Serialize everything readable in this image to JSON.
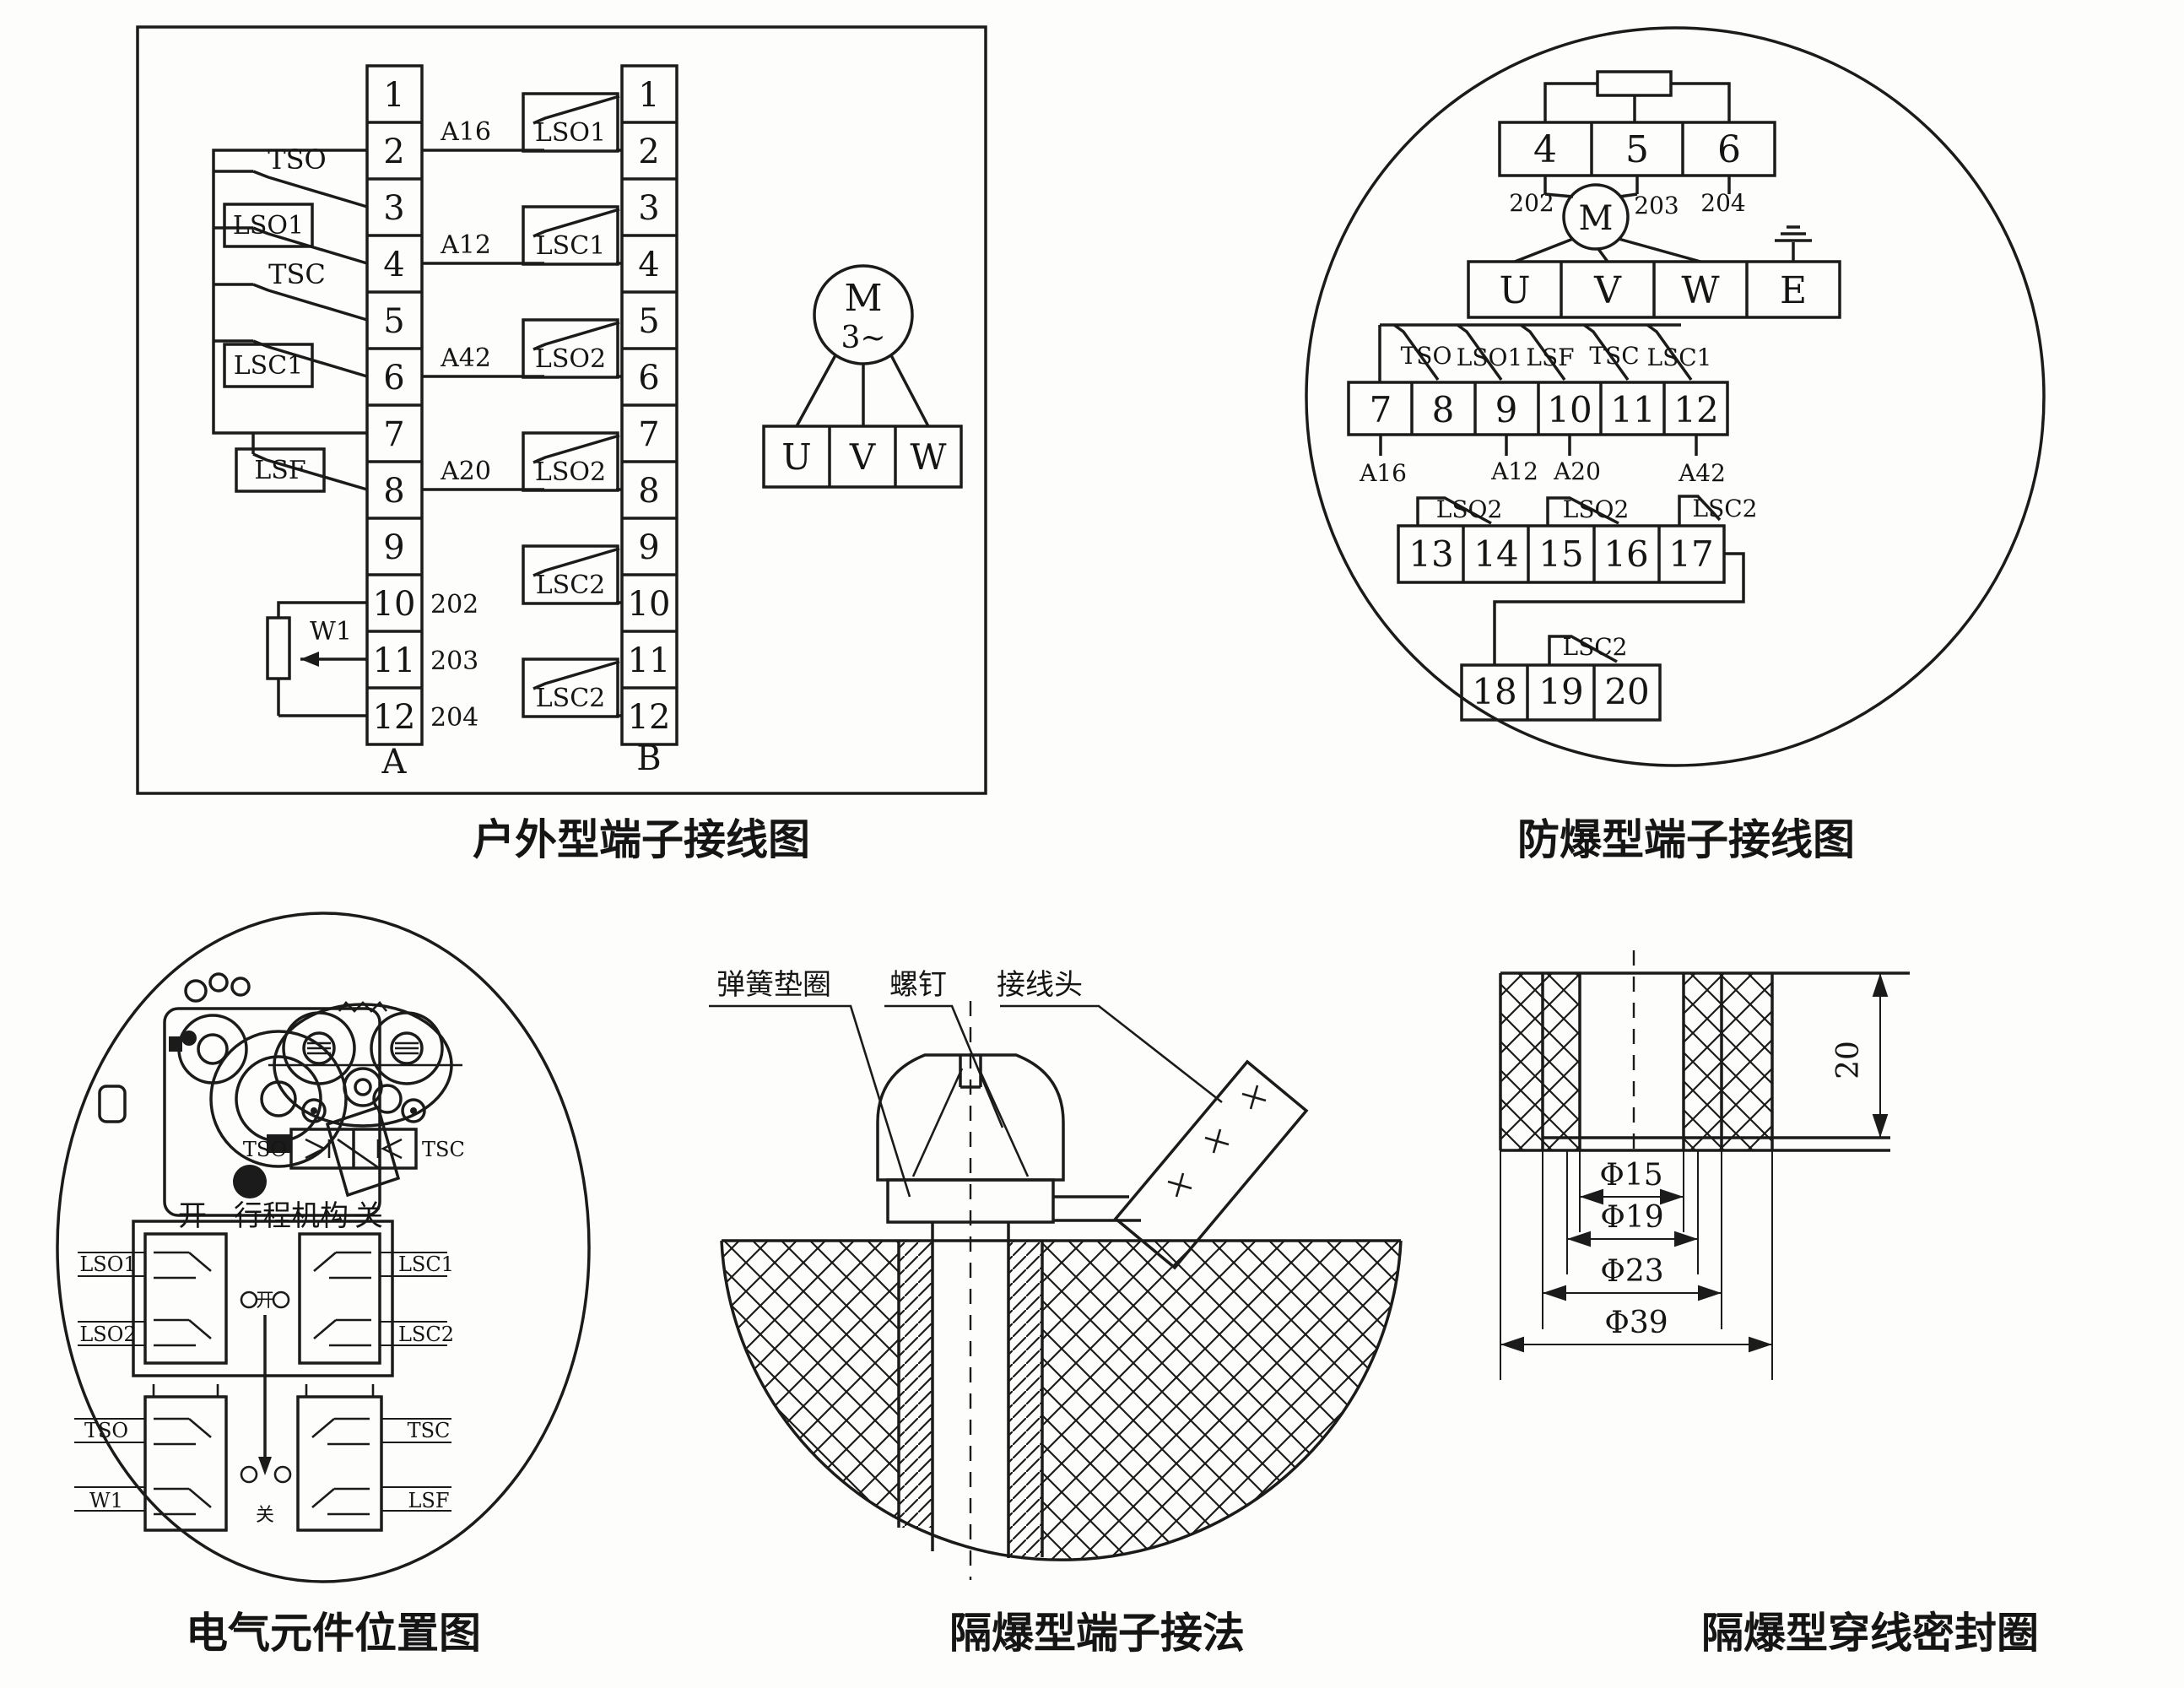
{
  "captions": {
    "outdoor": "户外型端子接线图",
    "explosion_proof": "防爆型端子接线图",
    "components": "电气元件位置图",
    "flameproof_terminal": "隔爆型端子接法",
    "flameproof_seal": "隔爆型穿线密封圈"
  },
  "outdoor": {
    "strip_a_label": "A",
    "strip_b_label": "B",
    "terminals": [
      "1",
      "2",
      "3",
      "4",
      "5",
      "6",
      "7",
      "8",
      "9",
      "10",
      "11",
      "12"
    ],
    "a_switches": [
      "TSO",
      "LSO1",
      "TSC",
      "LSC1",
      "LSF"
    ],
    "potentiometer": "W1",
    "wire_labels": [
      "A16",
      "A12",
      "A42",
      "A20"
    ],
    "analog_wires": [
      "202",
      "203",
      "204"
    ],
    "b_switches": [
      "LSO1",
      "LSC1",
      "LSO2",
      "LSO2",
      "LSC2",
      "LSC2"
    ],
    "motor_label": "M",
    "motor_phase": "3~",
    "phases": [
      "U",
      "V",
      "W"
    ]
  },
  "explosion_proof": {
    "top_terminals": [
      "4",
      "5",
      "6"
    ],
    "analog_wires": [
      "202",
      "203",
      "204"
    ],
    "motor_label": "M",
    "phase_terminals": [
      "U",
      "V",
      "W",
      "E"
    ],
    "row2_terminals": [
      "7",
      "8",
      "9",
      "10",
      "11",
      "12"
    ],
    "row2_switches": [
      "TSO",
      "LSO1",
      "LSF",
      "TSC",
      "LSC1"
    ],
    "row2_wires": [
      "A16",
      "A12",
      "A20",
      "A42"
    ],
    "row3_terminals": [
      "13",
      "14",
      "15",
      "16",
      "17"
    ],
    "row3_switches": [
      "LSO2",
      "LSO2",
      "LSC2"
    ],
    "row4_terminals": [
      "18",
      "19",
      "20"
    ],
    "row4_switch": "LSC2"
  },
  "components": {
    "torque_switches": [
      "TSO",
      "TSC"
    ],
    "header_left": "开",
    "header_title": "行程机构",
    "header_right": "关",
    "upper_left": [
      "LSO1",
      "LSO2"
    ],
    "upper_right": [
      "LSC1",
      "LSC2"
    ],
    "upper_center": "开",
    "lower_left": [
      "TSO",
      "W1"
    ],
    "lower_right": [
      "TSC",
      "LSF"
    ],
    "lower_center": "关"
  },
  "flameproof_terminal": {
    "labels": [
      "弹簧垫圈",
      "螺钉",
      "接线头"
    ]
  },
  "flameproof_seal": {
    "height": "20",
    "diameters": [
      "Φ15",
      "Φ19",
      "Φ23",
      "Φ39"
    ]
  }
}
